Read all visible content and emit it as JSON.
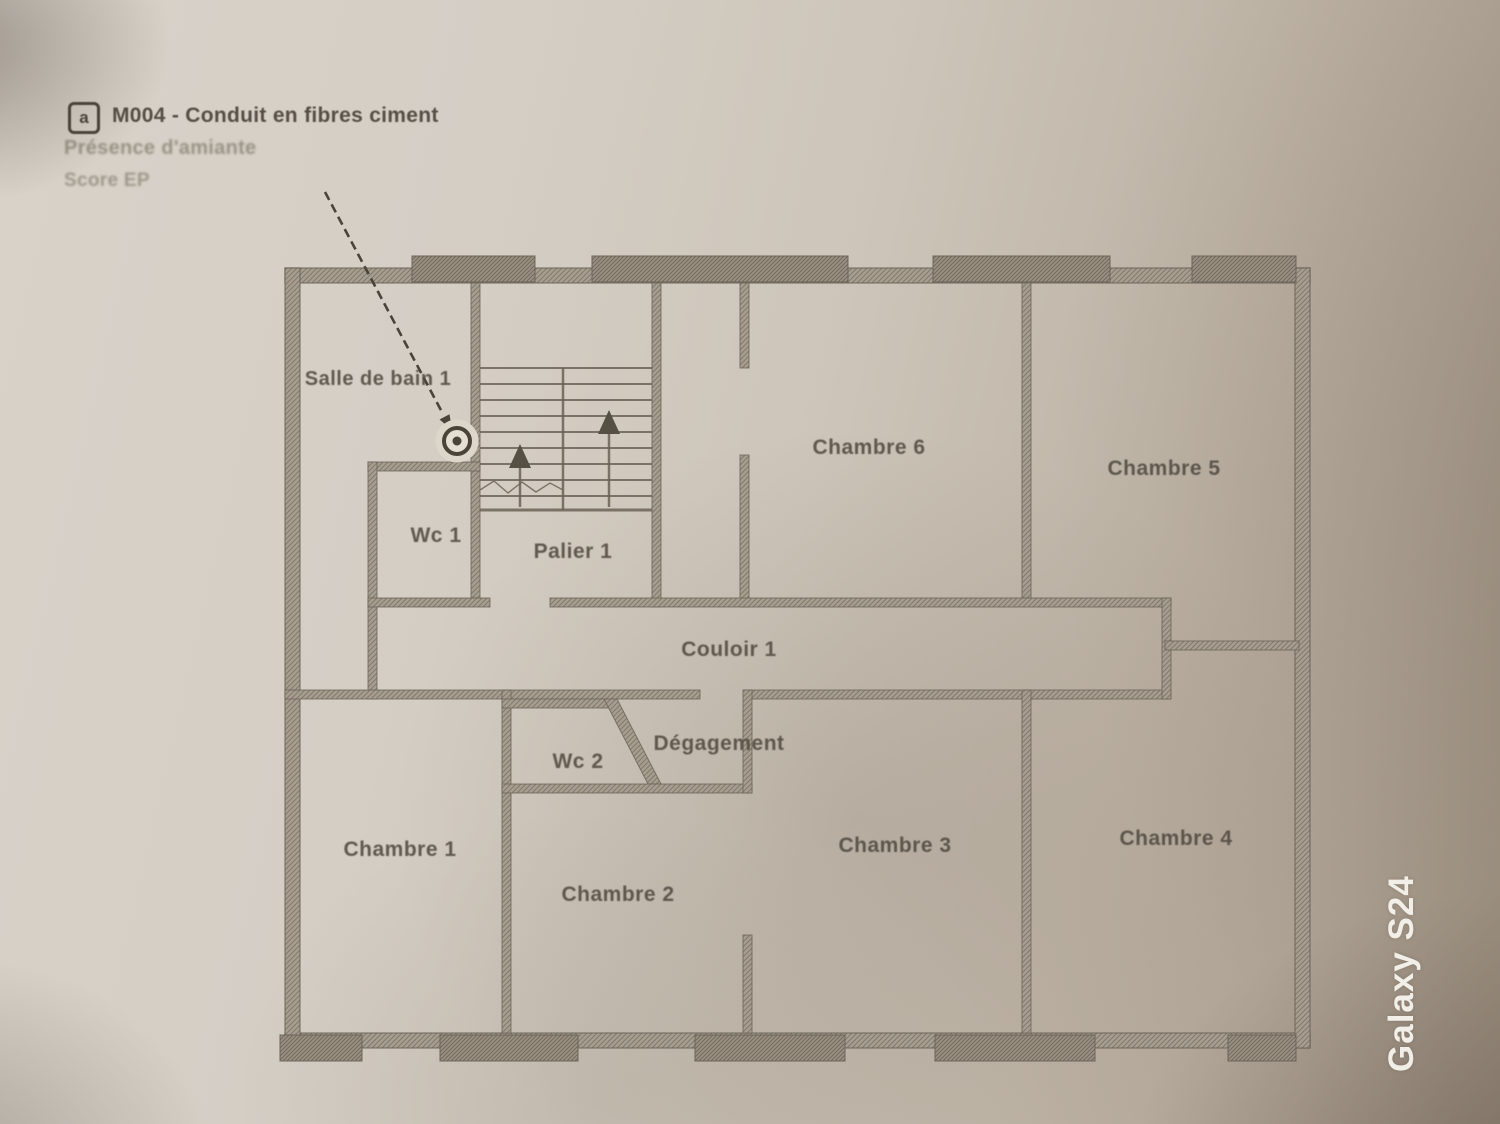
{
  "photo": {
    "device_watermark": "Galaxy S24"
  },
  "annotation": {
    "badge_letter": "a",
    "title": "M004 - Conduit en fibres ciment",
    "line2": "Présence d'amiante",
    "line3": "Score EP"
  },
  "rooms": [
    {
      "id": "salle-de-bain-1",
      "label": "Salle de bain 1"
    },
    {
      "id": "wc-1",
      "label": "Wc 1"
    },
    {
      "id": "palier-1",
      "label": "Palier 1"
    },
    {
      "id": "chambre-6",
      "label": "Chambre 6"
    },
    {
      "id": "chambre-5",
      "label": "Chambre 5"
    },
    {
      "id": "couloir-1",
      "label": "Couloir 1"
    },
    {
      "id": "wc-2",
      "label": "Wc 2"
    },
    {
      "id": "degagement",
      "label": "Dégagement"
    },
    {
      "id": "chambre-1",
      "label": "Chambre 1"
    },
    {
      "id": "chambre-2",
      "label": "Chambre 2"
    },
    {
      "id": "chambre-3",
      "label": "Chambre 3"
    },
    {
      "id": "chambre-4",
      "label": "Chambre 4"
    }
  ],
  "colors": {
    "ink": "#4b443b",
    "wall_hatch": "#a49b8d",
    "wall_edge": "#6b6357",
    "paper": "#d3ccc2",
    "watermark_text": "#f5f2ec"
  }
}
